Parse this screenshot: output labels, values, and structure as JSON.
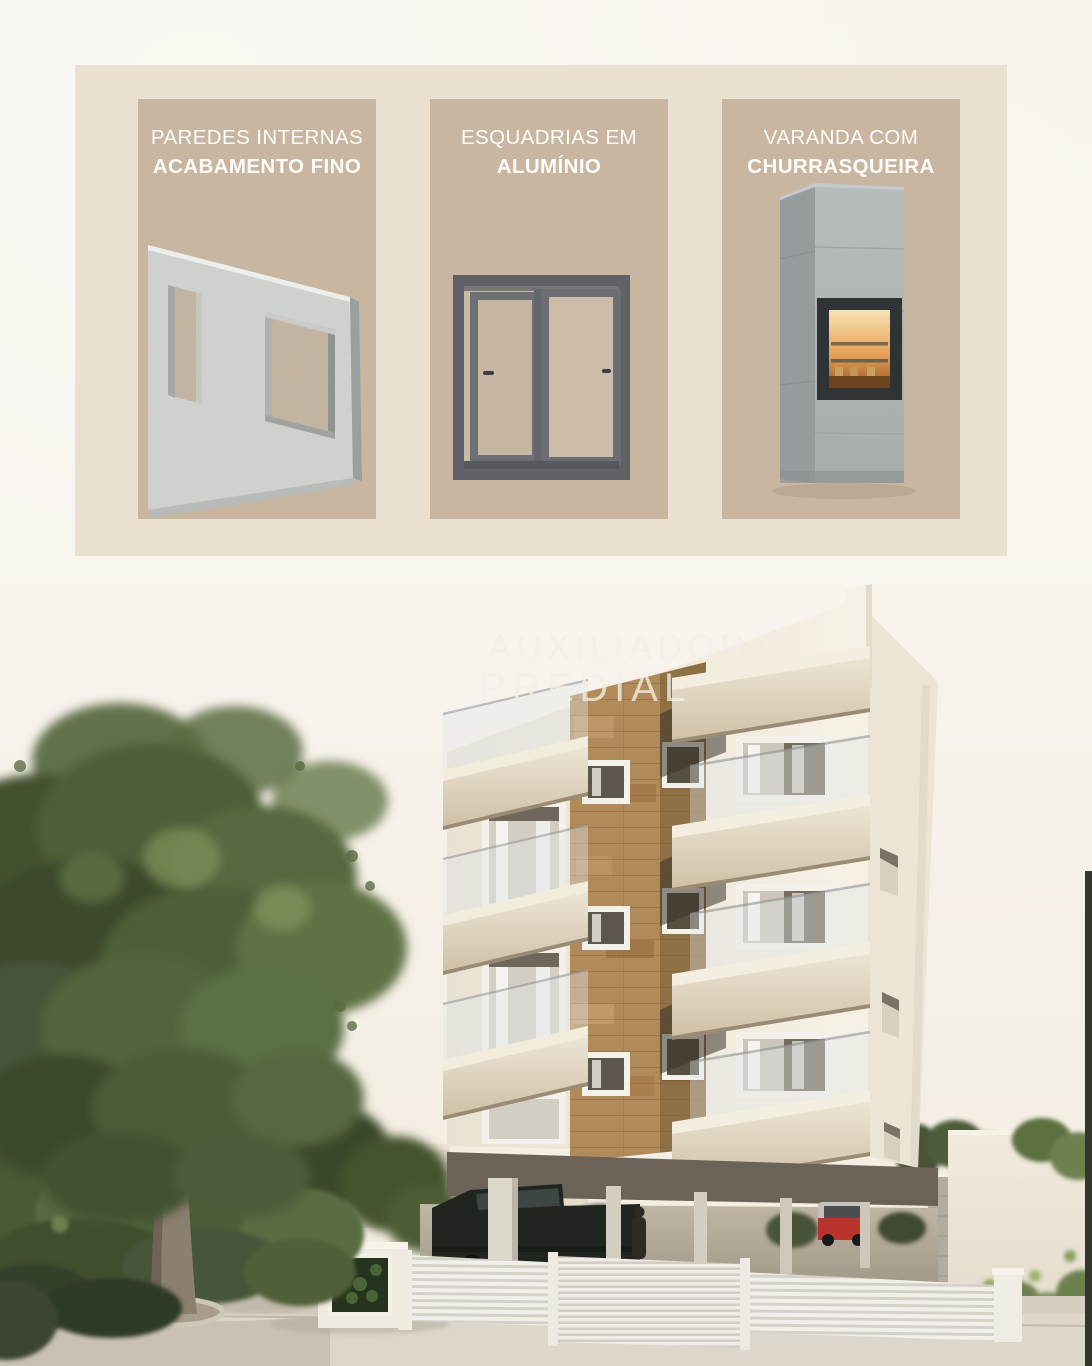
{
  "page": {
    "background_color": "#f7f2ec",
    "kind": "real-estate-feature-flyer"
  },
  "features": {
    "panel_background": "#eae1d2",
    "card_background": "#c8b6a0",
    "title_color": "#fdfcf9",
    "cards": [
      {
        "id": "paredes-internas",
        "line1": "PAREDES INTERNAS",
        "line2": "ACABAMENTO FINO",
        "illustration": "concrete-wall-panel"
      },
      {
        "id": "esquadrias",
        "line1": "ESQUADRIAS EM",
        "line2": "ALUMÍNIO",
        "illustration": "aluminum-sliding-window-frame"
      },
      {
        "id": "varanda",
        "line1": "VARANDA COM",
        "line2": "CHURRASQUEIRA",
        "illustration": "built-in-barbecue-grill"
      }
    ]
  },
  "render": {
    "scene": "apartment-building-3d-render",
    "watermark": {
      "line1": "AUXILIADORA",
      "line2": "PREDIAL"
    },
    "palette": {
      "facade": "#f3ede1",
      "balcony_slab": "#e6dcc9",
      "wood_strip": "#b08a58",
      "foliage": "#4d5f39",
      "sky": "#f8f4ee"
    }
  }
}
